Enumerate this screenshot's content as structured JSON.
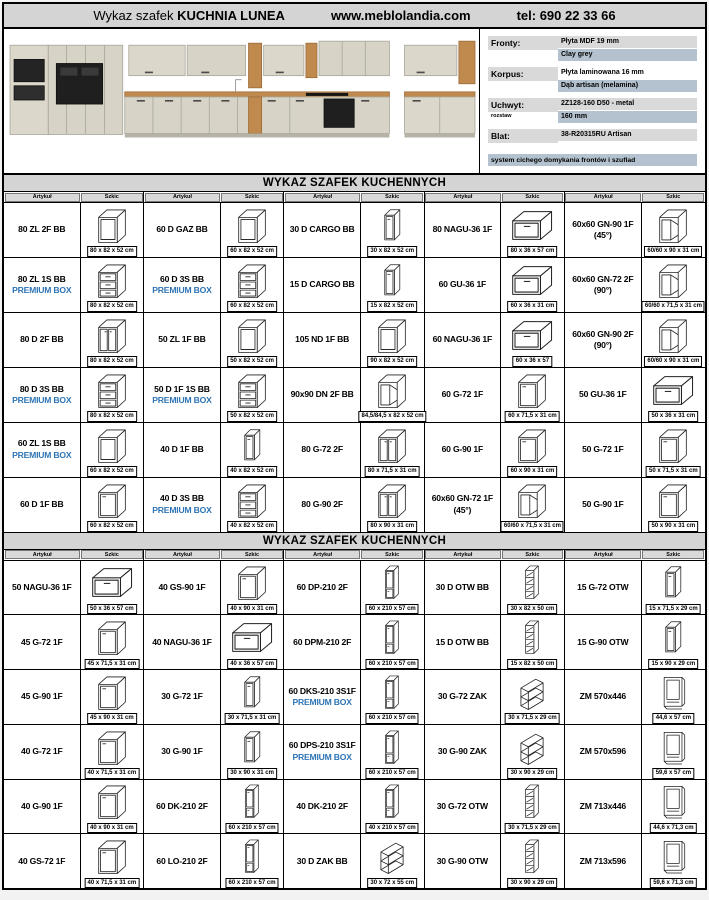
{
  "header": {
    "title_prefix": "Wykaz szafek",
    "title_name": "KUCHNIA LUNEA",
    "website": "www.meblolandia.com",
    "phone": "tel: 690 22 33 66"
  },
  "specs": {
    "rows": [
      {
        "label": "Fronty:",
        "line1": "Płyta MDF 19 mm",
        "line2": "Clay grey"
      },
      {
        "label": "Korpus:",
        "line1": "Płyta laminowana 16 mm",
        "line2": "Dąb artisan (melamina)"
      },
      {
        "label": "Uchwyt:",
        "sublabel": "rozstaw",
        "line1": "2Z128-160 D50 - metal",
        "line2": "160 mm"
      },
      {
        "label": "Blat:",
        "line1": "38-R20315RU Artisan"
      }
    ],
    "footer": "system cichego domykania frontów i szuflad"
  },
  "premium_label": "PREMIUM BOX",
  "colors": {
    "premium_blue": "#2E74B5",
    "header_bg": "#d4d4d4",
    "highlight_gray": "#d9d9d9",
    "highlight_blue": "#b3c2ce"
  },
  "table1": {
    "title": "WYKAZ SZAFEK KUCHENNYCH",
    "col_article": "Artykuł",
    "col_sketch": "Szkic",
    "rows": [
      [
        {
          "code": "80 ZL 2F BB",
          "dim": "80 x 82 x 52 cm",
          "sketch": "open"
        },
        {
          "code": "60 D GAZ BB",
          "dim": "60 x 82 x 52 cm",
          "sketch": "open"
        },
        {
          "code": "30 D CARGO BB",
          "dim": "30 x 82 x 52 cm",
          "sketch": "cargo"
        },
        {
          "code": "80 NAGU-36 1F",
          "dim": "80 x 36 x 57 cm",
          "sketch": "flat"
        },
        {
          "code": "60x60 GN-90 1F",
          "code2": "(45°)",
          "dim": "60/60 x 90 x 31 cm",
          "sketch": "corner"
        }
      ],
      [
        {
          "code": "80 ZL 1S BB",
          "premium": true,
          "dim": "80 x 82 x 52 cm",
          "sketch": "drawers"
        },
        {
          "code": "60 D 3S BB",
          "premium": true,
          "dim": "60 x 82 x 52 cm",
          "sketch": "drawers"
        },
        {
          "code": "15 D CARGO BB",
          "dim": "15 x 82 x 52 cm",
          "sketch": "cargo"
        },
        {
          "code": "60 GU-36 1F",
          "dim": "60 x 36 x 31 cm",
          "sketch": "flat"
        },
        {
          "code": "60x60 GN-72 2F",
          "code2": "(90°)",
          "dim": "60/60 x 71,5 x 31 cm",
          "sketch": "corner"
        }
      ],
      [
        {
          "code": "80 D 2F BB",
          "dim": "80 x 82 x 52 cm",
          "sketch": "door2"
        },
        {
          "code": "50 ZL 1F BB",
          "dim": "50 x 82 x 52 cm",
          "sketch": "open"
        },
        {
          "code": "105 ND 1F BB",
          "dim": "90 x 82 x 52 cm",
          "sketch": "open"
        },
        {
          "code": "60 NAGU-36 1F",
          "dim": "60 x 36 x 57",
          "sketch": "flat"
        },
        {
          "code": "60x60 GN-90 2F",
          "code2": "(90°)",
          "dim": "60/60 x 90 x 31 cm",
          "sketch": "corner"
        }
      ],
      [
        {
          "code": "80 D 3S BB",
          "premium": true,
          "dim": "80 x 82 x 52 cm",
          "sketch": "drawers"
        },
        {
          "code": "50 D 1F 1S BB",
          "premium": true,
          "dim": "50 x 82 x 52 cm",
          "sketch": "drawers"
        },
        {
          "code": "90x90 DN 2F BB",
          "dim": "84,5/84,5 x 82 x 52 cm",
          "sketch": "corner"
        },
        {
          "code": "60 G-72 1F",
          "dim": "60 x 71,5 x 31 cm",
          "sketch": "door"
        },
        {
          "code": "50 GU-36 1F",
          "dim": "50 x 36 x 31 cm",
          "sketch": "flat"
        }
      ],
      [
        {
          "code": "60 ZL 1S BB",
          "premium": true,
          "dim": "60 x 82 x 52 cm",
          "sketch": "open"
        },
        {
          "code": "40 D 1F BB",
          "dim": "40 x 82 x 52 cm",
          "sketch": "cargo"
        },
        {
          "code": "80 G-72 2F",
          "dim": "80 x 71,5 x 31 cm",
          "sketch": "door2"
        },
        {
          "code": "60 G-90 1F",
          "dim": "60 x 90 x 31 cm",
          "sketch": "door"
        },
        {
          "code": "50 G-72 1F",
          "dim": "50 x 71,5 x 31 cm",
          "sketch": "door"
        }
      ],
      [
        {
          "code": "60 D 1F BB",
          "dim": "60 x 82 x 52 cm",
          "sketch": "door"
        },
        {
          "code": "40 D 3S BB",
          "premium": true,
          "dim": "40 x 82 x 52 cm",
          "sketch": "drawers"
        },
        {
          "code": "80 G-90 2F",
          "dim": "80 x 90 x 31 cm",
          "sketch": "door2"
        },
        {
          "code": "60x60 GN-72 1F",
          "code2": "(45°)",
          "dim": "60/60 x 71,5 x 31 cm",
          "sketch": "corner"
        },
        {
          "code": "50 G-90 1F",
          "dim": "50 x 90 x 31 cm",
          "sketch": "door"
        }
      ]
    ]
  },
  "table2": {
    "title": "WYKAZ SZAFEK KUCHENNYCH",
    "col_article": "Artykuł",
    "col_sketch": "Szkic",
    "rows": [
      [
        {
          "code": "50 NAGU-36 1F",
          "dim": "50 x 36 x 57 cm",
          "sketch": "flat"
        },
        {
          "code": "40 GS-90 1F",
          "dim": "40 x 90 x 31 cm",
          "sketch": "door"
        },
        {
          "code": "60 DP-210 2F",
          "dim": "60 x 210 x 57 cm",
          "sketch": "tallcol"
        },
        {
          "code": "30 D OTW BB",
          "dim": "30 x 82 x 50 cm",
          "sketch": "shelf"
        },
        {
          "code": "15 G-72 OTW",
          "dim": "15 x 71,5 x 29 cm",
          "sketch": "cargo"
        }
      ],
      [
        {
          "code": "45 G-72 1F",
          "dim": "45 x 71,5 x 31 cm",
          "sketch": "door"
        },
        {
          "code": "40 NAGU-36 1F",
          "dim": "40 x 36 x 57 cm",
          "sketch": "flat"
        },
        {
          "code": "60 DPM-210 2F",
          "dim": "60 x 210 x 57 cm",
          "sketch": "tallcol"
        },
        {
          "code": "15 D OTW BB",
          "dim": "15 x 82 x 50 cm",
          "sketch": "shelf"
        },
        {
          "code": "15 G-90 OTW",
          "dim": "15 x 90 x 29 cm",
          "sketch": "cargo"
        }
      ],
      [
        {
          "code": "45 G-90 1F",
          "dim": "45 x 90 x 31 cm",
          "sketch": "door"
        },
        {
          "code": "30 G-72 1F",
          "dim": "30 x 71,5 x 31 cm",
          "sketch": "cargo"
        },
        {
          "code": "60 DKS-210 3S1F",
          "premium": true,
          "dim": "60 x 210 x 57 cm",
          "sketch": "tallcol"
        },
        {
          "code": "30 G-72 ZAK",
          "dim": "30 x 71,5 x 29 cm",
          "sketch": "zigzag"
        },
        {
          "code": "ZM 570x446",
          "dim": "44,6 x 57 cm",
          "sketch": "frame"
        }
      ],
      [
        {
          "code": "40 G-72 1F",
          "dim": "40 x 71,5 x 31 cm",
          "sketch": "door"
        },
        {
          "code": "30 G-90 1F",
          "dim": "30 x 90 x 31 cm",
          "sketch": "cargo"
        },
        {
          "code": "60 DPS-210 3S1F",
          "premium": true,
          "dim": "60 x 210 x 57 cm",
          "sketch": "tallcol"
        },
        {
          "code": "30 G-90 ZAK",
          "dim": "30 x 90 x 29 cm",
          "sketch": "zigzag"
        },
        {
          "code": "ZM 570x596",
          "dim": "59,6 x 57 cm",
          "sketch": "frame"
        }
      ],
      [
        {
          "code": "40 G-90 1F",
          "dim": "40 x 90 x 31 cm",
          "sketch": "door"
        },
        {
          "code": "60 DK-210 2F",
          "dim": "60 x 210 x 57 cm",
          "sketch": "tallcol"
        },
        {
          "code": "40 DK-210 2F",
          "dim": "40 x 210 x 57 cm",
          "sketch": "tallcol"
        },
        {
          "code": "30 G-72 OTW",
          "dim": "30 x 71,5 x 29 cm",
          "sketch": "shelf"
        },
        {
          "code": "ZM 713x446",
          "dim": "44,6 x 71,3 cm",
          "sketch": "frame"
        }
      ],
      [
        {
          "code": "40 GS-72 1F",
          "dim": "40 x 71,5 x 31 cm",
          "sketch": "door"
        },
        {
          "code": "60 LO-210 2F",
          "dim": "60 x 210 x 57 cm",
          "sketch": "tallcol"
        },
        {
          "code": "30 D ZAK BB",
          "dim": "30 x 72 x 55 cm",
          "sketch": "zigzag"
        },
        {
          "code": "30 G-90 OTW",
          "dim": "30 x 90 x 29 cm",
          "sketch": "shelf"
        },
        {
          "code": "ZM 713x596",
          "dim": "59,6 x 71,3 cm",
          "sketch": "frame"
        }
      ]
    ]
  }
}
